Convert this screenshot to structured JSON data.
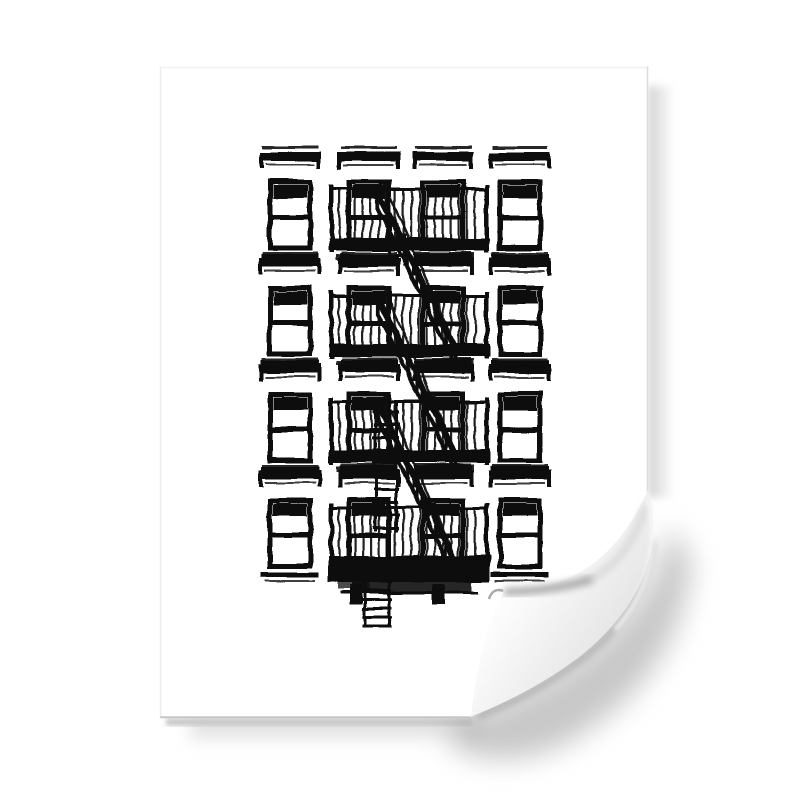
{
  "scene": {
    "description": "Product photo of an unframed white poster print with a curled bottom-right corner on a plain white background",
    "colors": {
      "background": "#ffffff",
      "paper": "#ffffff",
      "ink": "#0f0f0f",
      "edge_line": "#c6c6c6",
      "shadow_soft": "#c9c9c9",
      "shadow_dark": "#9a9a9a",
      "curl_back_light": "#fdfdfd",
      "curl_back_mid": "#ececec",
      "curl_back_dark": "#cccccc",
      "crease_shadow": "#8c8c8c"
    }
  },
  "poster": {
    "bounds": {
      "left": 160,
      "top": 67,
      "right": 648,
      "bottom": 718
    },
    "curl_corner": "bottom-right"
  },
  "artwork": {
    "subject": "Black and white print of a New York City apartment building facade with fire escape",
    "style": "high-contrast black ink photograph on white paper",
    "grid": {
      "rows": 4,
      "columns": 4
    },
    "window_columns_x": [
      270,
      349,
      423,
      500
    ],
    "window_row_tops_y": [
      182,
      288,
      394,
      500
    ],
    "window_size": {
      "width": 40,
      "height": 66
    },
    "fire_escape": {
      "balconies": 4,
      "stair_flights": 3,
      "has_drop_ladder": true,
      "span_x": [
        330,
        488
      ]
    }
  }
}
